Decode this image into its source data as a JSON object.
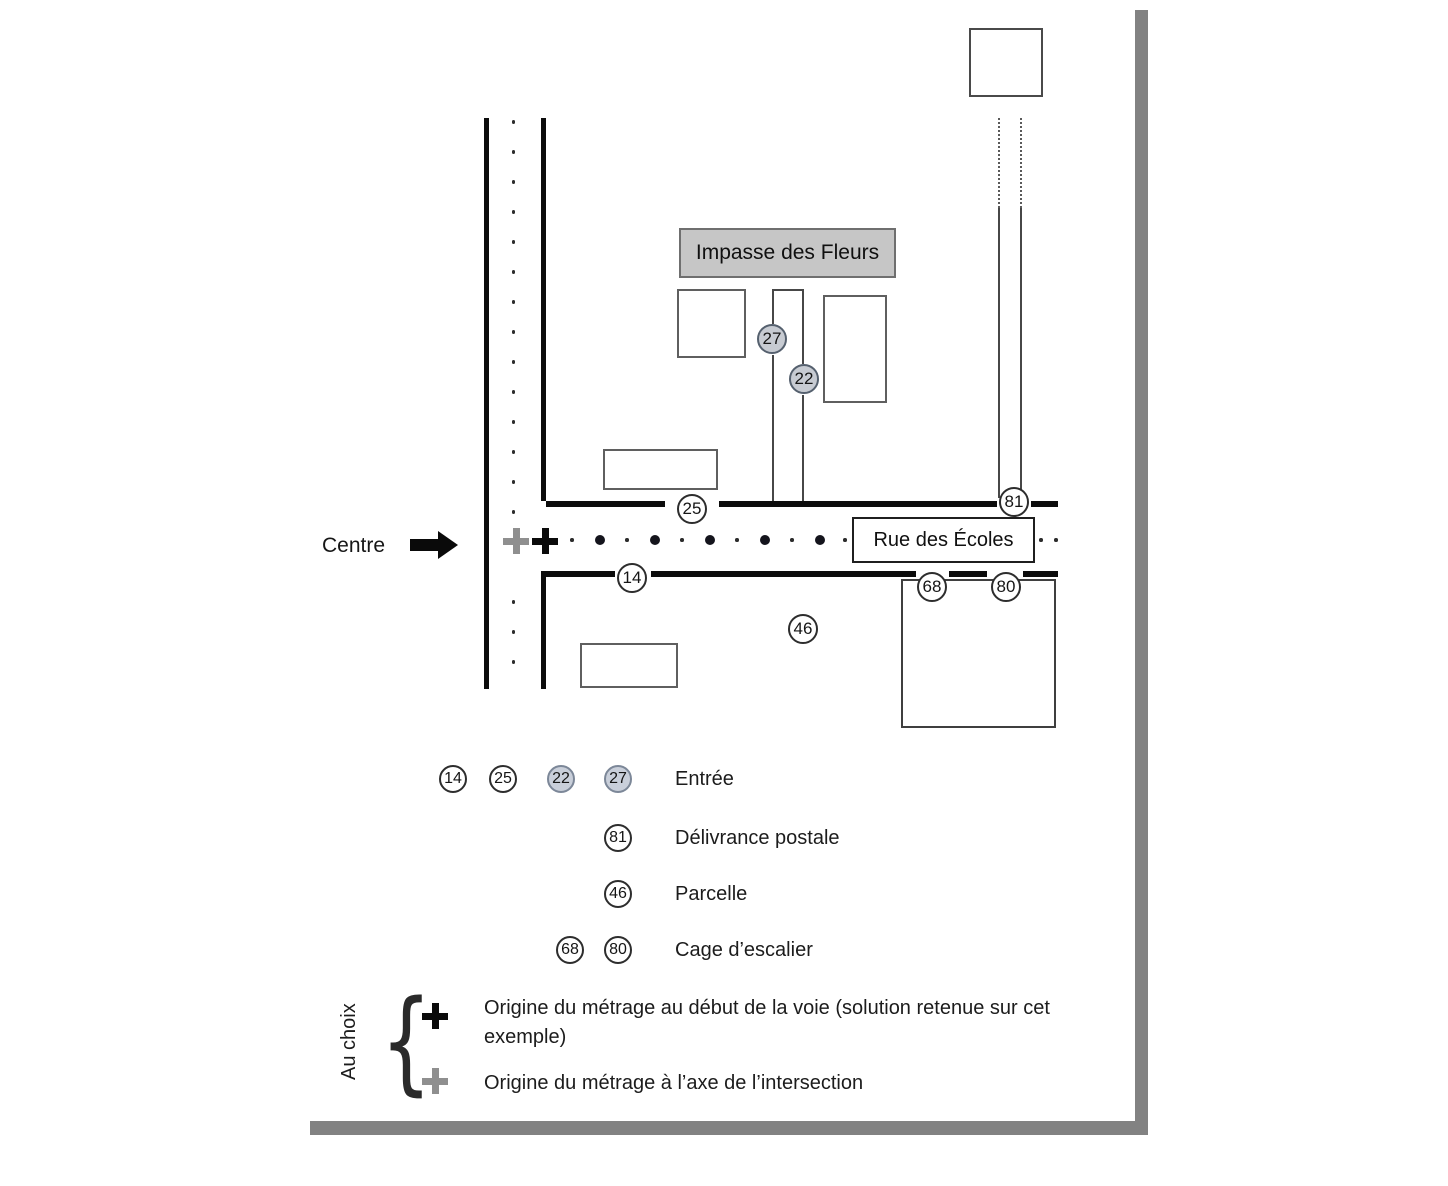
{
  "map": {
    "centre_label": "Centre",
    "impasse_label": "Impasse des Fleurs",
    "street_label": "Rue des Écoles",
    "markers": [
      {
        "n": "25",
        "x": 692,
        "y": 509,
        "filled": false
      },
      {
        "n": "14",
        "x": 632,
        "y": 578,
        "filled": false
      },
      {
        "n": "27",
        "x": 772,
        "y": 339,
        "filled": true
      },
      {
        "n": "22",
        "x": 804,
        "y": 379,
        "filled": true
      },
      {
        "n": "81",
        "x": 1014,
        "y": 502,
        "filled": false
      },
      {
        "n": "46",
        "x": 803,
        "y": 629,
        "filled": false
      },
      {
        "n": "68",
        "x": 932,
        "y": 587,
        "filled": false
      },
      {
        "n": "80",
        "x": 1006,
        "y": 587,
        "filled": false
      }
    ]
  },
  "legend_rows": [
    {
      "label": "Entrée",
      "circles": [
        {
          "n": "14",
          "filled": false
        },
        {
          "n": "25",
          "filled": false
        },
        {
          "n": "22",
          "filled": true
        },
        {
          "n": "27",
          "filled": true
        }
      ]
    },
    {
      "label": "Délivrance postale",
      "circles": [
        {
          "n": "81",
          "filled": false
        }
      ]
    },
    {
      "label": "Parcelle",
      "circles": [
        {
          "n": "46",
          "filled": false
        }
      ]
    },
    {
      "label": "Cage d’escalier",
      "circles": [
        {
          "n": "68",
          "filled": false
        },
        {
          "n": "80",
          "filled": false
        }
      ]
    }
  ],
  "au_choix": {
    "label": "Au choix",
    "items": [
      {
        "symbol": "plus-black",
        "text": "Origine du métrage au début de la voie (solution retenue sur cet exemple)"
      },
      {
        "symbol": "plus-gray",
        "text": "Origine du métrage à l’axe de l’intersection"
      }
    ]
  },
  "colors": {
    "road": "#0c0c0c",
    "shadow": "#828282",
    "label_fill": "#c6c6c6",
    "filled_marker": "#c9cfda",
    "gray_plus": "#8f8f8f",
    "street_dot": "#14141c"
  }
}
